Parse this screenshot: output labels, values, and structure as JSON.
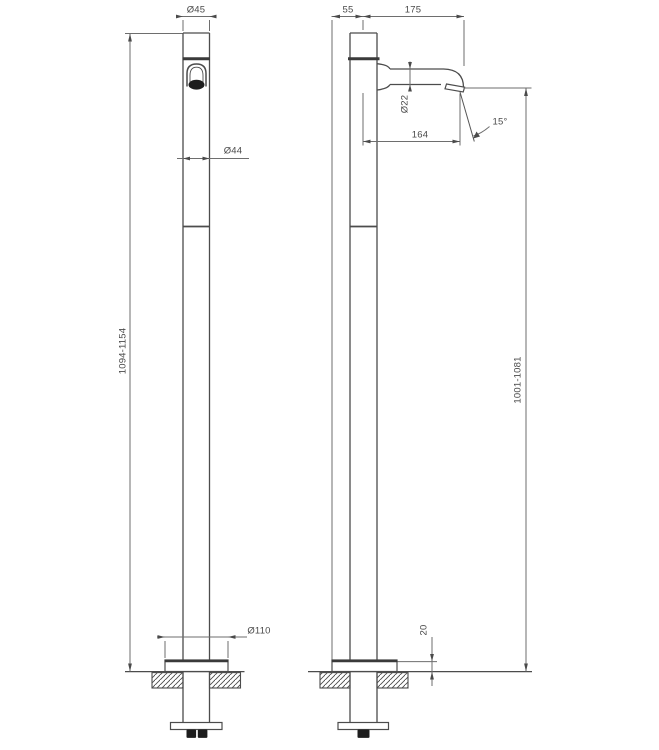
{
  "drawing": {
    "type": "technical-dimension-drawing",
    "subject": "freestanding single-hole faucet, front and side elevation",
    "front_view": {
      "dims": {
        "cap_diameter": "Ø45",
        "body_diameter": "Ø44",
        "base_plate_diameter": "Ø110",
        "overall_height_range": "1094-1154"
      }
    },
    "side_view": {
      "dims": {
        "base_edge_to_axis": "55",
        "spout_reach": "175",
        "spout_tube_diameter": "Ø22",
        "outlet_offset": "164",
        "outlet_angle": "15°",
        "outlet_height_range": "1001-1081",
        "base_plate_height": "20"
      }
    }
  }
}
